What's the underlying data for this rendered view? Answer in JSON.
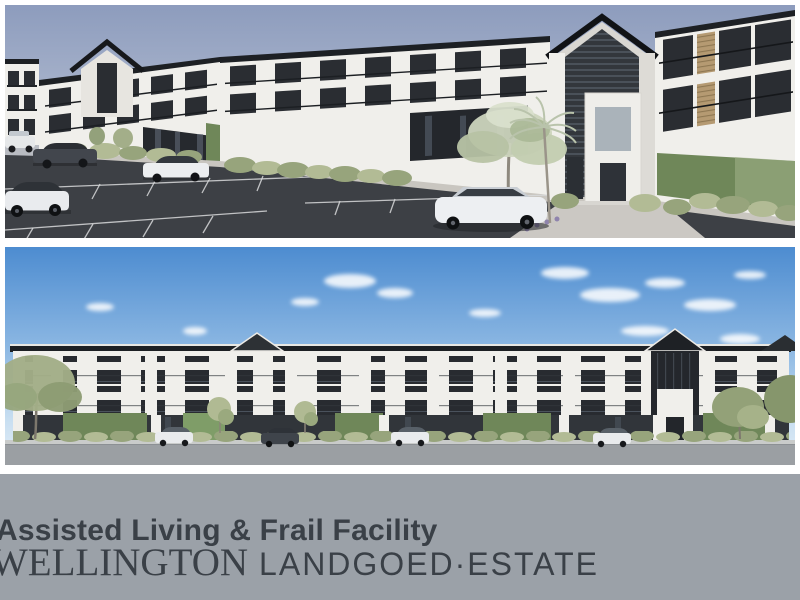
{
  "banner": {
    "subtitle": "Assisted Living & Frail Facility",
    "title_primary": "WELLINGTON",
    "title_secondary": "LANDGOED·ESTATE"
  },
  "icons": {
    "accessible_parking": "♿"
  },
  "colors": {
    "wall_white": "#f0efeb",
    "roof_dark": "#1d2024",
    "window_dark": "#2a2d32",
    "accent_green": "#6f8759",
    "accent_green_bright": "#7f9d68",
    "hedge_green": "#97a47c",
    "hedge_green_light": "#b2bb95",
    "asphalt": "#3d4045",
    "road_gray": "#9b9fa3",
    "sky_muted_top": "#8d9cbd",
    "sky_muted_bottom": "#dcdfe7",
    "sky_blue_top": "#4d8cd0",
    "sky_blue_bottom": "#e4eef7",
    "banner_bg": "#9ba1a8",
    "banner_text": "#3a4047",
    "wood_slat": "#b59a72"
  }
}
